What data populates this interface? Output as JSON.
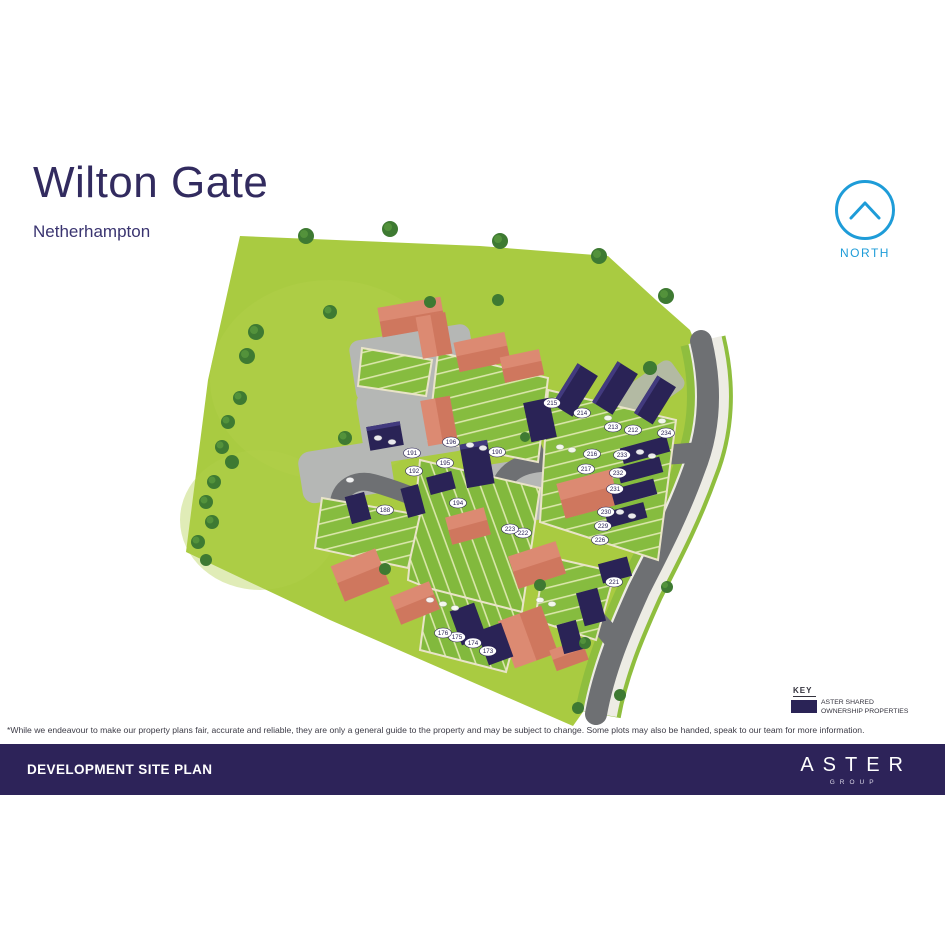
{
  "page": {
    "title": "Wilton Gate",
    "subtitle": "Netherhampton"
  },
  "north": {
    "label": "NORTH",
    "color": "#1e9cd8"
  },
  "key": {
    "heading": "KEY",
    "swatch_color": "#2a2356",
    "item_line1": "ASTER SHARED",
    "item_line2": "OWNERSHIP PROPERTIES"
  },
  "disclaimer": "*While we endeavour to make our property plans fair, accurate and reliable, they are only a general guide to the property and may be subject to change. Some plots may also be handed, speak to our team for more information.",
  "footer": {
    "title": "DEVELOPMENT SITE PLAN",
    "brand": "ASTER",
    "brand_sub": "GROUP"
  },
  "colors": {
    "navy": "#2a2356",
    "footer_navy": "#2d2359",
    "blue": "#1e9cd8",
    "field_green": "#a9cb41",
    "garden_green": "#86bc3f",
    "tree_green": "#3e7a32",
    "road_grey": "#6e7073",
    "courtyard_grey": "#b5b7b5",
    "roof_salmon": "#dc8a72"
  },
  "map": {
    "plots": [
      {
        "n": "173",
        "x": 488,
        "y": 651
      },
      {
        "n": "174",
        "x": 473,
        "y": 643
      },
      {
        "n": "175",
        "x": 457,
        "y": 637
      },
      {
        "n": "176",
        "x": 443,
        "y": 633
      },
      {
        "n": "188",
        "x": 385,
        "y": 510
      },
      {
        "n": "190",
        "x": 497,
        "y": 452
      },
      {
        "n": "191",
        "x": 412,
        "y": 453
      },
      {
        "n": "192",
        "x": 414,
        "y": 471
      },
      {
        "n": "194",
        "x": 458,
        "y": 503
      },
      {
        "n": "195",
        "x": 445,
        "y": 463
      },
      {
        "n": "196",
        "x": 451,
        "y": 442
      },
      {
        "n": "212",
        "x": 633,
        "y": 430
      },
      {
        "n": "213",
        "x": 613,
        "y": 427
      },
      {
        "n": "214",
        "x": 582,
        "y": 413
      },
      {
        "n": "215",
        "x": 552,
        "y": 403
      },
      {
        "n": "216",
        "x": 592,
        "y": 454
      },
      {
        "n": "217",
        "x": 586,
        "y": 469
      },
      {
        "n": "221",
        "x": 614,
        "y": 582
      },
      {
        "n": "222",
        "x": 523,
        "y": 533
      },
      {
        "n": "223",
        "x": 510,
        "y": 529
      },
      {
        "n": "226",
        "x": 600,
        "y": 540
      },
      {
        "n": "229",
        "x": 603,
        "y": 526
      },
      {
        "n": "230",
        "x": 606,
        "y": 512
      },
      {
        "n": "231",
        "x": 615,
        "y": 489
      },
      {
        "n": "232",
        "x": 618,
        "y": 473
      },
      {
        "n": "233",
        "x": 622,
        "y": 455
      },
      {
        "n": "234",
        "x": 666,
        "y": 433
      }
    ]
  }
}
